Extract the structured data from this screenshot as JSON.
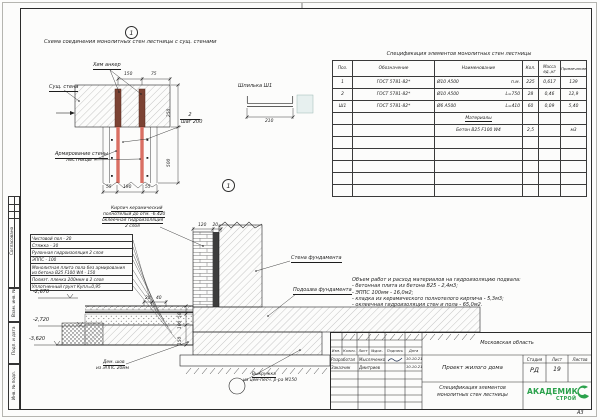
{
  "sheet": {
    "format": "А3"
  },
  "markers": {
    "detail1": "1",
    "detail2": "1"
  },
  "detail1": {
    "title": "Схема соединения монолитных стен лестницы с сущ. стенами",
    "labels": {
      "chem_anchor": "Хим анкер",
      "exist_wall": "Сущ. стена",
      "reinf1": "Армирование стены",
      "reinf2": "лестницы",
      "qty": "2",
      "step": "шаг 200"
    },
    "dims": {
      "top1": "150",
      "top2": "75",
      "right1": "250",
      "right2": "500",
      "b1": "55",
      "b2": "190",
      "b3": "55"
    }
  },
  "stud": {
    "title": "Шпилька Ш1",
    "dim": "210"
  },
  "spec_table": {
    "title": "Спецификация элементов монолитных стен лестницы",
    "headers": {
      "pos": "Поз.",
      "doc": "Обозначение",
      "name": "Наименование",
      "qty": "Кол.",
      "mass1": "Масса",
      "mass2": "ед.,кг",
      "note": "Примечание"
    },
    "rows": [
      {
        "pos": "1",
        "doc": "ГОСТ 5781-82*",
        "name": "Ø10 А500",
        "len": "п.м.",
        "qty": "225",
        "mass": "0,617",
        "note": "139"
      },
      {
        "pos": "2",
        "doc": "ГОСТ 5781-82*",
        "name": "Ø10 А500",
        "len": "L=750",
        "qty": "28",
        "mass": "0,46",
        "note": "12,9"
      },
      {
        "pos": "Ш1",
        "doc": "ГОСТ 5781-82*",
        "name": "Ø6 А500",
        "len": "L=410",
        "qty": "60",
        "mass": "0,09",
        "note": "5,40"
      }
    ],
    "materials_header": "Материалы",
    "materials": {
      "name": "Бетон В25 F100 W4",
      "qty": "2,5",
      "note": "м3"
    }
  },
  "floor_layers": {
    "l1": "Чистовой пол - 20",
    "l2": "Стяжка - 30",
    "l3": "Рулонная гидроизоляция 2 слоя",
    "l4": "ЭППС - 100",
    "l5a": "Монолитная плита пола без армирования",
    "l5b": "из бетона В25 F100 W4 - 150",
    "l6": "Полиэт. пленка 200мкм в 2 слоя",
    "l7": "Уплотненный грунт Купл=0,95"
  },
  "section": {
    "elev1": "-2,670",
    "elev2": "-2,720",
    "elev3": "-3,620",
    "brick1": "Кирпич керамический",
    "brick2": "полнотелый до отм. -6.420",
    "brick3": "оклеечная гидроизоляция",
    "brick4": "2 слоя",
    "wall_label": "Стена фундамента",
    "footing_label": "Подошва фундамента",
    "joint1": "Дем. шов",
    "joint2": "из ЭППС 20мм",
    "fillet1": "Выкружка",
    "fillet2": "из цем-песч. р-ра М150",
    "dims": {
      "d120": "120",
      "d20": "20",
      "d20a": "20",
      "d40": "40",
      "d50": "50",
      "d100": "100",
      "d150": "150"
    }
  },
  "notes": {
    "n0": "Объем работ и расход материалов на гидроизоляцию подвала:",
    "n1": "- бетонная плита из бетона В25 - 2,4м3;",
    "n2": "- ЭППС 100мм - 16,0м2;",
    "n3": "- кладка из керамического полнотелого кирпича - 5,3м3;",
    "n4": "- оклеечная гидроизоляция стен и пола - 65,0м2."
  },
  "title_block": {
    "region": "Московская область",
    "project": "Проект жилого дома",
    "doc1": "Спецификация элементов",
    "doc2": "монолитных стен лестницы",
    "stage_label": "Стадия",
    "sheet_label": "Лист",
    "sheets_label": "Листов",
    "stage": "РД",
    "sheet_no": "19",
    "sheets_no": "",
    "cols": {
      "c1": "Изм.",
      "c2": "Колич.",
      "c3": "Лист",
      "c4": "№док.",
      "c5": "Подпись",
      "c6": "Дата"
    },
    "row1": {
      "role": "Разработал",
      "name": "Мысляченко",
      "date": "10.10.21"
    },
    "row2": {
      "role": "Заказчик",
      "name": "Дмитриев",
      "date": "10.10.21"
    },
    "logo1": "АКАДЕМИК",
    "logo2": "СТРОЙ"
  },
  "side": {
    "s1": "Согласовано",
    "s2": "Взам. инв. №",
    "s3": "Подп. и дата",
    "s4": "Инв. № подл."
  },
  "colors": {
    "accent_green": "#2aa14b",
    "rebar_red": "#d96f63",
    "anchor_brown": "#7c4334"
  }
}
